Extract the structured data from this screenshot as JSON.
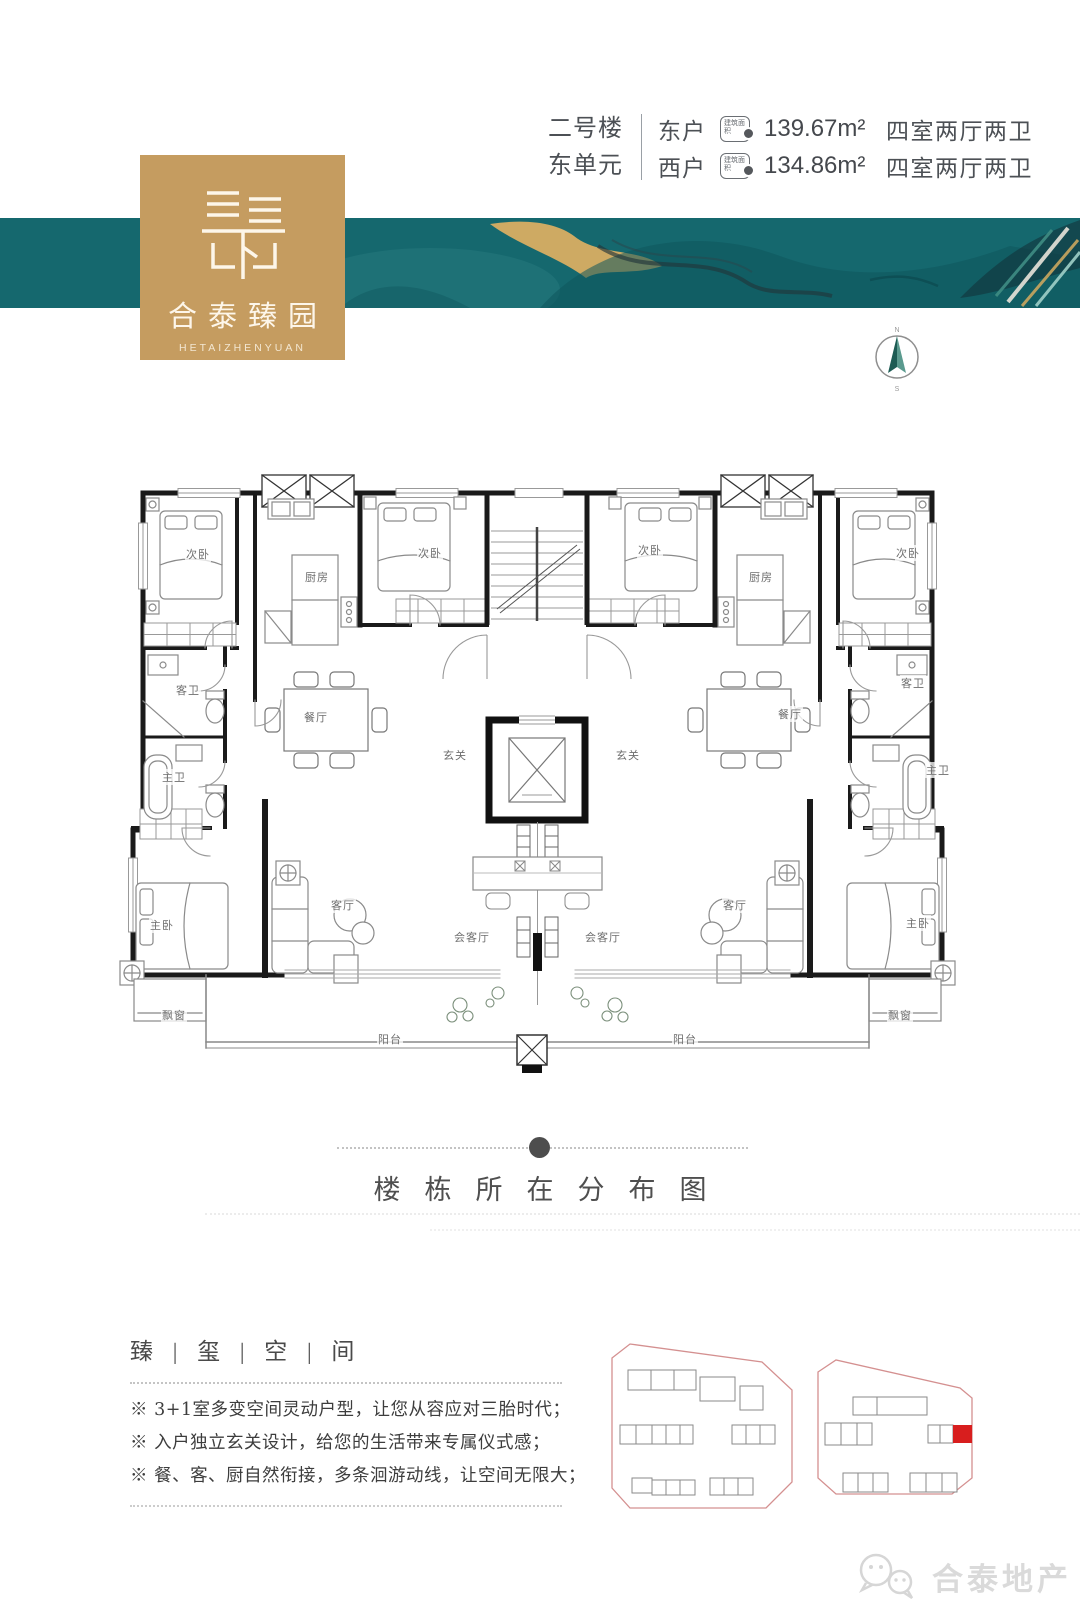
{
  "header": {
    "building": "二号楼",
    "unit": "东单元",
    "badge": "建筑面积",
    "rows": [
      {
        "household": "东户",
        "area": "139.67m²",
        "layout": "四室两厅两卫"
      },
      {
        "household": "西户",
        "area": "134.86m²",
        "layout": "四室两厅两卫"
      }
    ]
  },
  "logo": {
    "cn": "合泰臻园",
    "en": "HETAIZHENYUAN"
  },
  "compass": {
    "north": "N",
    "south": "S"
  },
  "colors": {
    "teal": "#15686e",
    "gold": "#c59c60",
    "highlight_red": "#d81e1e"
  },
  "floorplan": {
    "rooms": [
      {
        "label": "次卧",
        "x": 198,
        "y": 554
      },
      {
        "label": "厨房",
        "x": 317,
        "y": 577
      },
      {
        "label": "次卧",
        "x": 430,
        "y": 553
      },
      {
        "label": "客卫",
        "x": 188,
        "y": 690
      },
      {
        "label": "主卫",
        "x": 174,
        "y": 777
      },
      {
        "label": "餐厅",
        "x": 316,
        "y": 717
      },
      {
        "label": "玄关",
        "x": 455,
        "y": 755
      },
      {
        "label": "主卧",
        "x": 162,
        "y": 925
      },
      {
        "label": "客厅",
        "x": 343,
        "y": 905
      },
      {
        "label": "会客厅",
        "x": 472,
        "y": 937
      },
      {
        "label": "飘窗",
        "x": 174,
        "y": 1015
      },
      {
        "label": "阳台",
        "x": 390,
        "y": 1039
      },
      {
        "label": "次卧",
        "x": 650,
        "y": 550
      },
      {
        "label": "厨房",
        "x": 761,
        "y": 577
      },
      {
        "label": "次卧",
        "x": 908,
        "y": 553
      },
      {
        "label": "客卫",
        "x": 913,
        "y": 683
      },
      {
        "label": "主卫",
        "x": 938,
        "y": 770
      },
      {
        "label": "餐厅",
        "x": 790,
        "y": 714
      },
      {
        "label": "玄关",
        "x": 628,
        "y": 755
      },
      {
        "label": "主卧",
        "x": 918,
        "y": 923
      },
      {
        "label": "客厅",
        "x": 735,
        "y": 905
      },
      {
        "label": "会客厅",
        "x": 603,
        "y": 937
      },
      {
        "label": "飘窗",
        "x": 900,
        "y": 1015
      },
      {
        "label": "阳台",
        "x": 685,
        "y": 1039
      }
    ]
  },
  "distribution": {
    "title": "楼栋所在分布图"
  },
  "features": {
    "heading": "臻 | 玺 | 空 | 间",
    "items": [
      "※ 3+1室多变空间灵动户型，让您从容应对三胎时代；",
      "※ 入户独立玄关设计，给您的生活带来专属仪式感；",
      "※ 餐、客、厨自然衔接，多条洄游动线，让空间无限大；"
    ]
  },
  "watermark": {
    "brand": "合泰地产"
  }
}
